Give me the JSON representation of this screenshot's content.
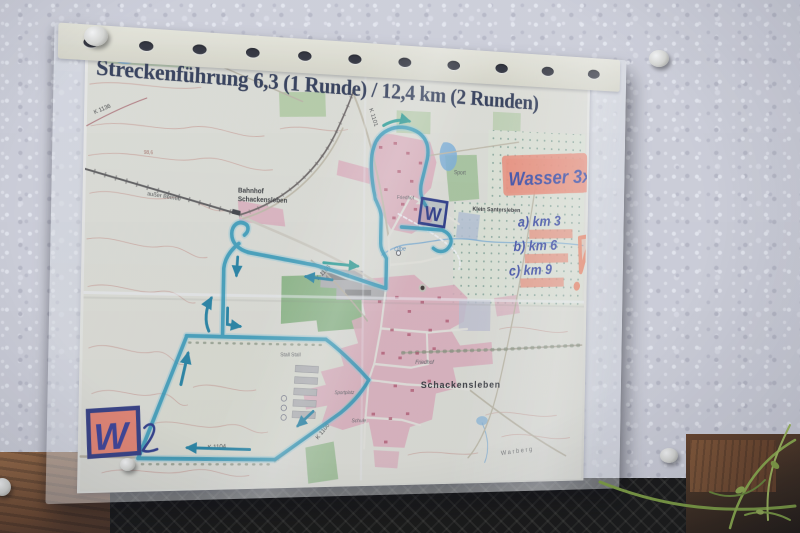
{
  "title": "Streckenführung 6,3 (1 Runde) / 12,4 km (2 Runden)",
  "annotations": {
    "water_note": "Wasser 3x",
    "water_station_label": "W",
    "km_marks": [
      "a) km 3",
      "b) km 6",
      "c) km 9"
    ],
    "exclamation": "!"
  },
  "map": {
    "labels": {
      "bahnhof_line1": "Bahnhof",
      "bahnhof_line2": "Schackensleben",
      "ausser_betrieb": "außer Betrieb",
      "klein_santersleben": "Klein Santersleben",
      "sport": "Sport",
      "friedhof_north": "Friedhof",
      "friedhof_south": "Friedhof",
      "schackensleben": "Schackensleben",
      "warberg": "Warberg",
      "stall": "Stall Stall",
      "schule": "Schule",
      "sportplatz": "Sportplatz",
      "olbe": "Olbe",
      "elevation_point": "98,6"
    },
    "roads": {
      "k1104": "K 1104",
      "k1106_lower": "K 1106",
      "k1106_upper": "K 1106",
      "k1101": "K 1101",
      "k1136": "K 1136"
    }
  },
  "colors": {
    "route_teal": "#1a93b4",
    "ink_blue": "#2a3a9e",
    "highlighter_orange": "#f8886a",
    "village_pink": "#e7adb9",
    "forest_green": "#8cb97c",
    "wall": "#d4d5de",
    "paper": "#f6f4ec"
  }
}
